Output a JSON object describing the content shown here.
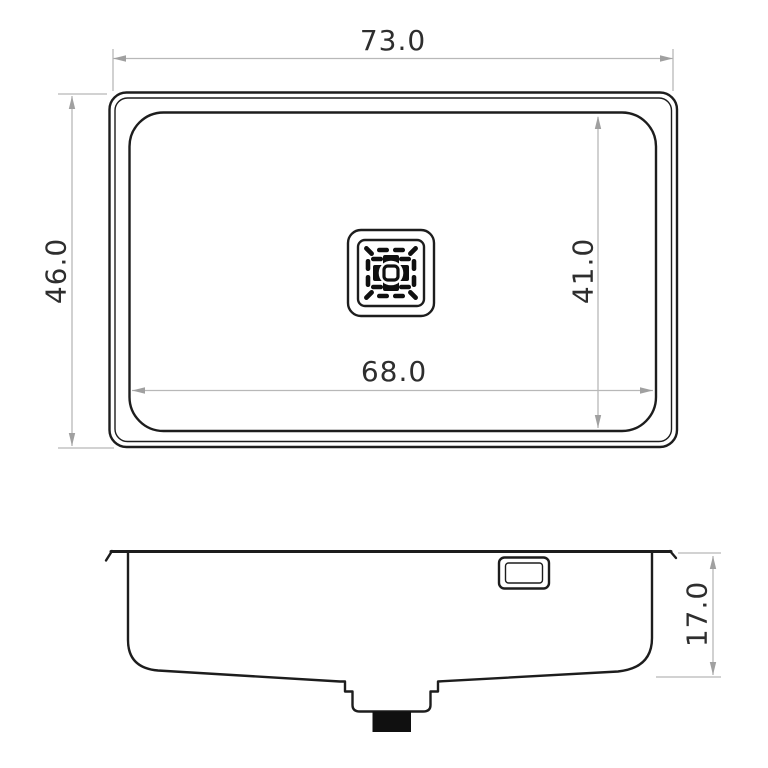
{
  "drawing": {
    "type": "technical-dimension-drawing",
    "subject": "undermount-sink",
    "colors": {
      "background": "#ffffff",
      "outline": "#1d1d1d",
      "dim_line": "#b8b8b8",
      "dim_arrow": "#a0a0a0",
      "dim_text": "#2e2e2e"
    },
    "top_view": {
      "overall_width": "73.0",
      "overall_depth": "46.0",
      "bowl_width": "68.0",
      "bowl_depth": "41.0"
    },
    "side_view": {
      "bowl_height": "17.0"
    }
  }
}
